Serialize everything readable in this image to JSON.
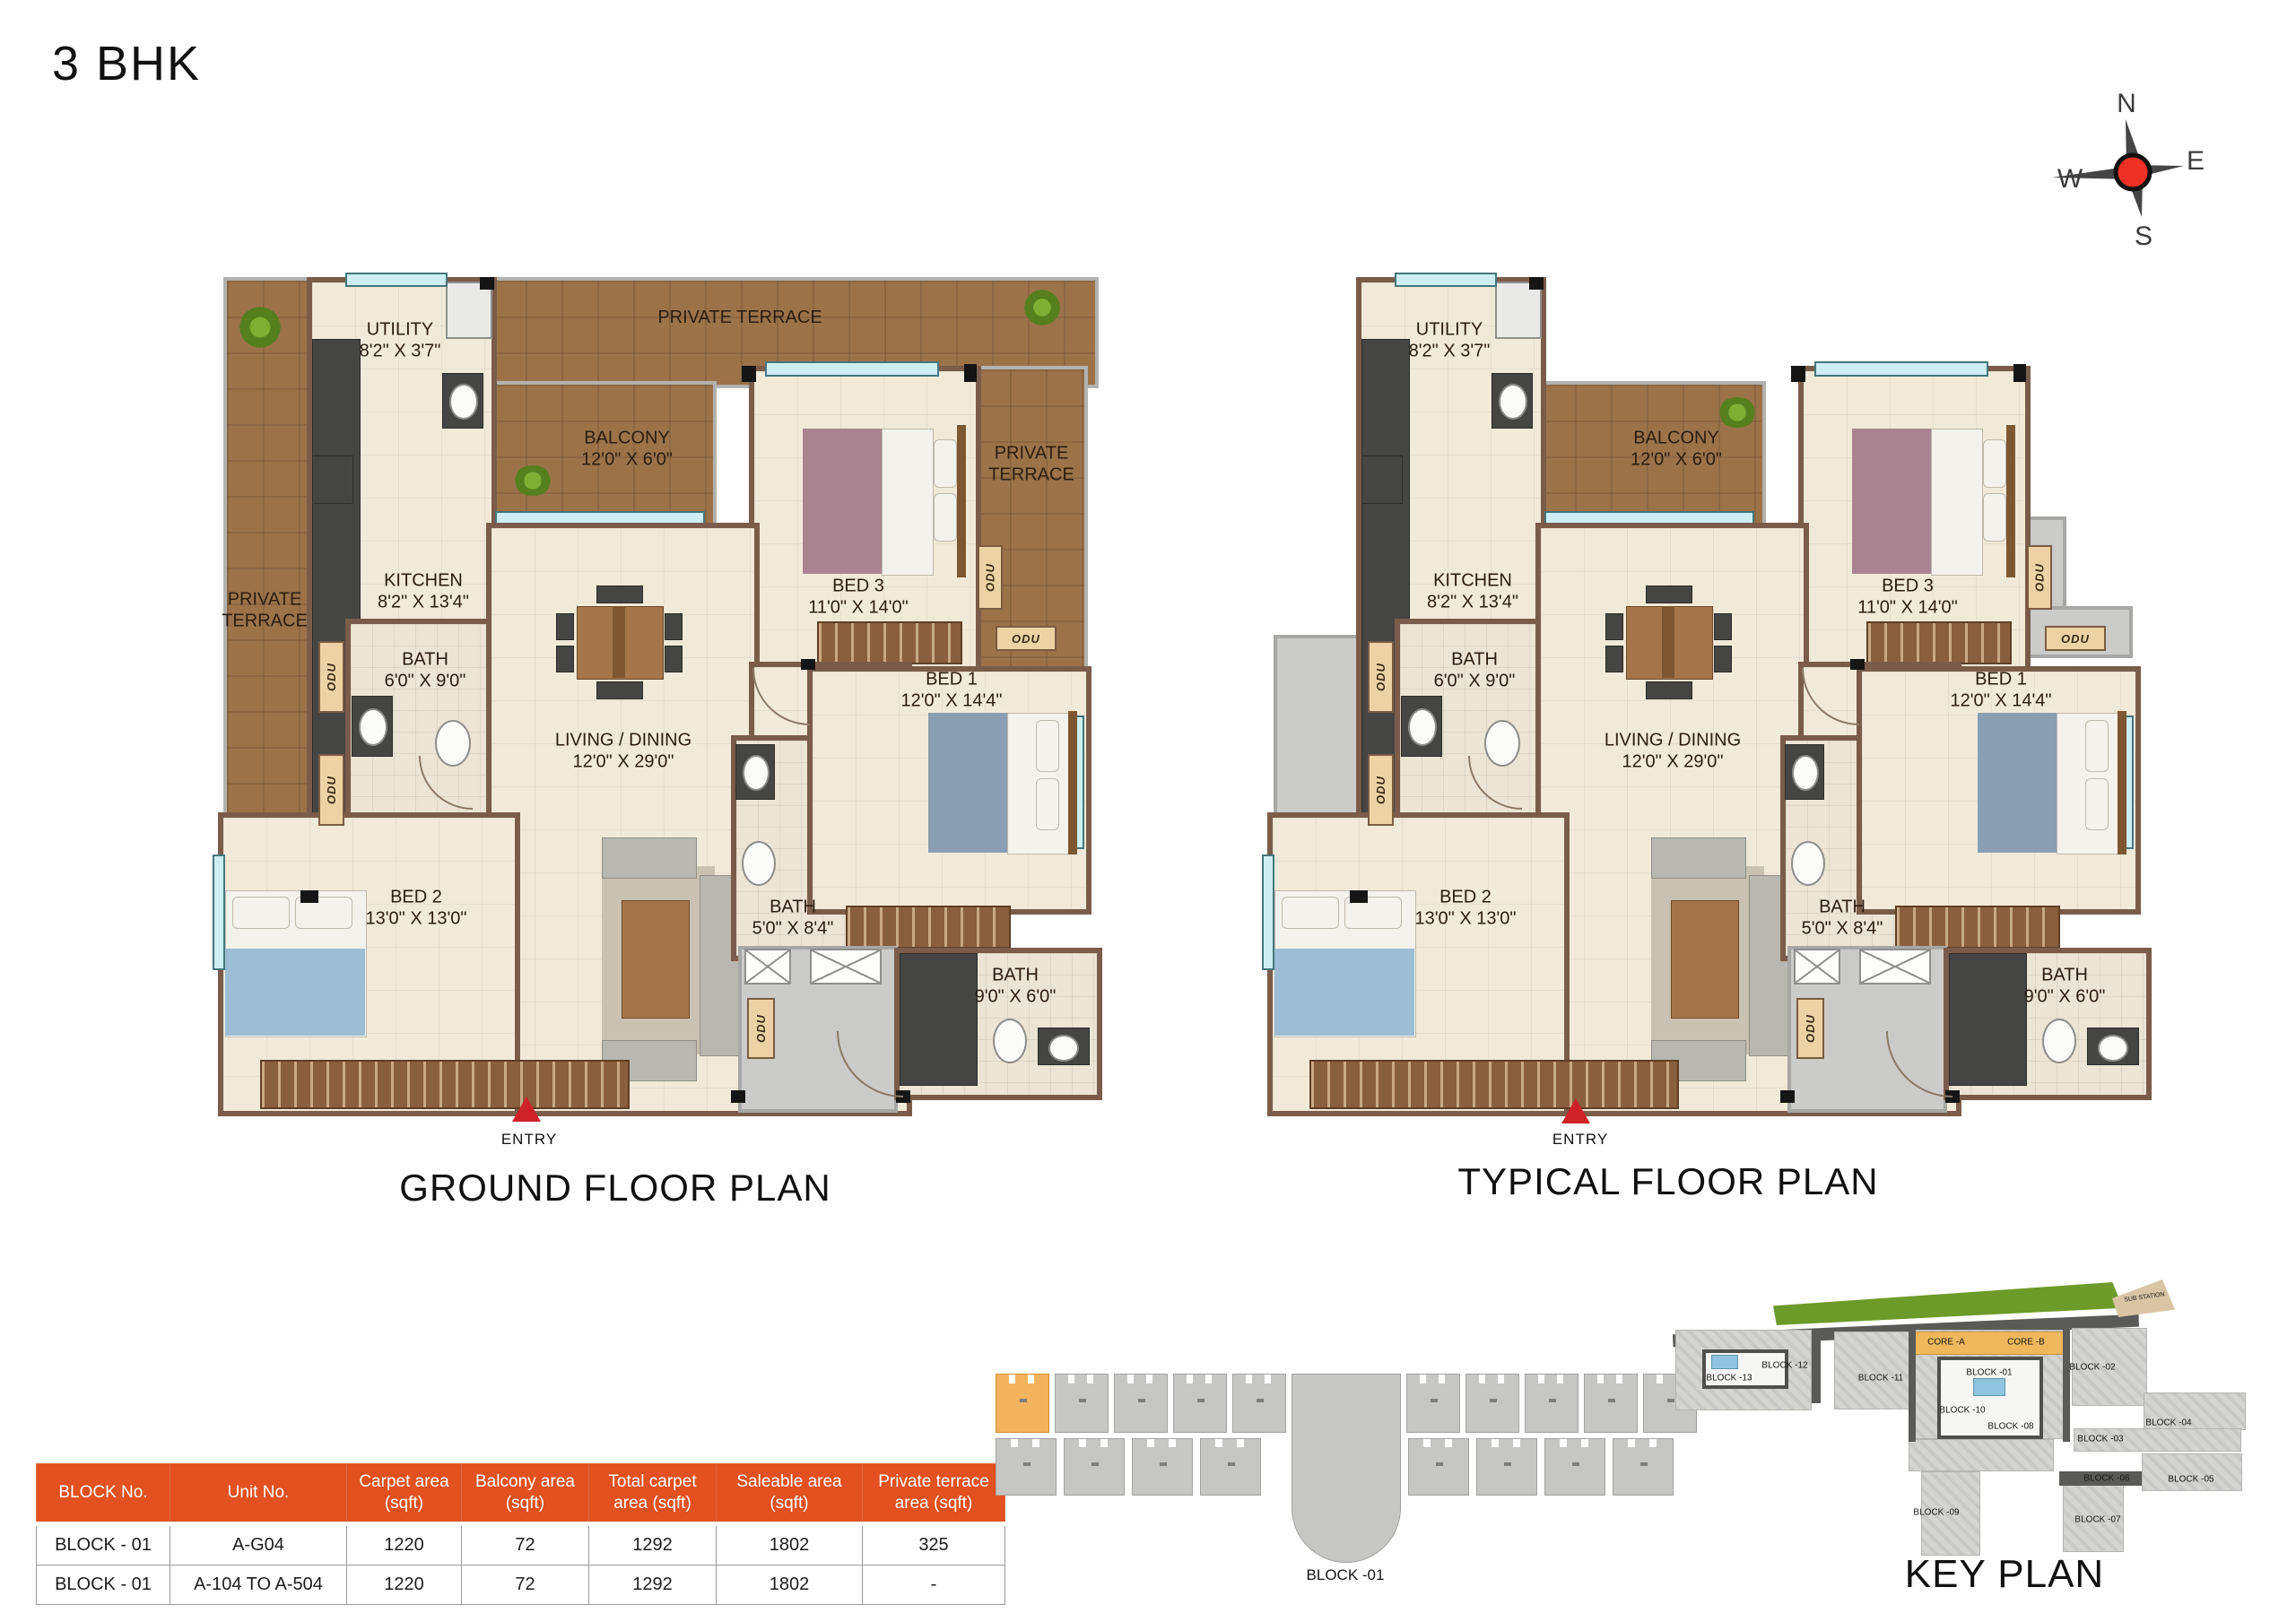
{
  "title": "3 BHK",
  "compass": {
    "north": "N",
    "south": "S",
    "east": "E",
    "west": "W"
  },
  "rooms": {
    "utility": {
      "name": "UTILITY",
      "dim": "8'2\" X 3'7\""
    },
    "kitchen": {
      "name": "KITCHEN",
      "dim": "8'2\" X 13'4\""
    },
    "balcony": {
      "name": "BALCONY",
      "dim": "12'0\" X 6'0\""
    },
    "living_dining": {
      "name": "LIVING / DINING",
      "dim": "12'0\" X 29'0\""
    },
    "bed1": {
      "name": "BED 1",
      "dim": "12'0\" X 14'4\""
    },
    "bed2": {
      "name": "BED 2",
      "dim": "13'0\" X 13'0\""
    },
    "bed3": {
      "name": "BED 3",
      "dim": "11'0\" X 14'0\""
    },
    "bath_common": {
      "name": "BATH",
      "dim": "6'0\" X 9'0\""
    },
    "bath_bed1": {
      "name": "BATH",
      "dim": "5'0\" X 8'4\""
    },
    "bath_bed3": {
      "name": "BATH",
      "dim": "9'0\" X 6'0\""
    },
    "private_terrace": "PRIVATE TERRACE",
    "private_terrace_line1": "PRIVATE",
    "private_terrace_line2": "TERRACE",
    "odu": "ODU"
  },
  "plans": {
    "ground": {
      "title": "GROUND FLOOR PLAN",
      "entry": "ENTRY"
    },
    "typical": {
      "title": "TYPICAL FLOOR PLAN",
      "entry": "ENTRY"
    }
  },
  "area_table": {
    "headers": [
      "BLOCK No.",
      "Unit No.",
      "Carpet area (sqft)",
      "Balcony area (sqft)",
      "Total carpet area (sqft)",
      "Saleable area (sqft)",
      "Private terrace area (sqft)"
    ],
    "rows": [
      [
        "BLOCK - 01",
        "A-G04",
        "1220",
        "72",
        "1292",
        "1802",
        "325"
      ],
      [
        "BLOCK - 01",
        "A-104 TO A-504",
        "1220",
        "72",
        "1292",
        "1802",
        "-"
      ]
    ]
  },
  "block_diagram": {
    "label": "BLOCK -01"
  },
  "key_plan": {
    "title": "KEY PLAN",
    "labels": [
      "BLOCK -13",
      "BLOCK -12",
      "BLOCK -11",
      "CORE -A",
      "CORE -B",
      "BLOCK -01",
      "BLOCK -02",
      "BLOCK -10",
      "BLOCK -08",
      "BLOCK -04",
      "BLOCK -03",
      "BLOCK -06",
      "BLOCK -05",
      "BLOCK -09",
      "BLOCK -07",
      "SUB STATION"
    ]
  },
  "colors": {
    "accent_orange": "#e2511f",
    "terrace_brown": "#9c7349",
    "wall_brown": "#7b5c4a",
    "highlight_unit": "#f2b35c",
    "compass_red": "#ee3124",
    "entry_red": "#cf2128",
    "keyplan_green": "#6d9b2a"
  }
}
